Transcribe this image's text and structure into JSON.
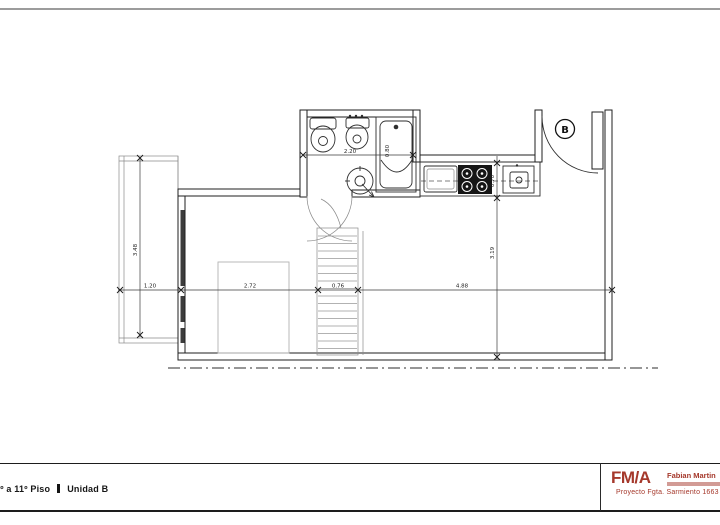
{
  "footer": {
    "floor_label": "1º a 11º Piso",
    "unit_label": "Unidad B"
  },
  "title_block": {
    "logo": "FM/A",
    "architect": "Fabian Martin",
    "project": "Proyecto  Fgta. Sarmiento 1663",
    "accent_color": "#a5382b"
  },
  "plan": {
    "unit_label": "B",
    "dimensions": {
      "bath_width": "2.20",
      "tub_width": "0.80",
      "balcony_width": "1.20",
      "balcony_height": "3.48",
      "living_width": "2.72",
      "stair_width": "0.76",
      "main_width": "4.88",
      "counter_depth": "0.70",
      "room_depth": "3.19"
    }
  }
}
